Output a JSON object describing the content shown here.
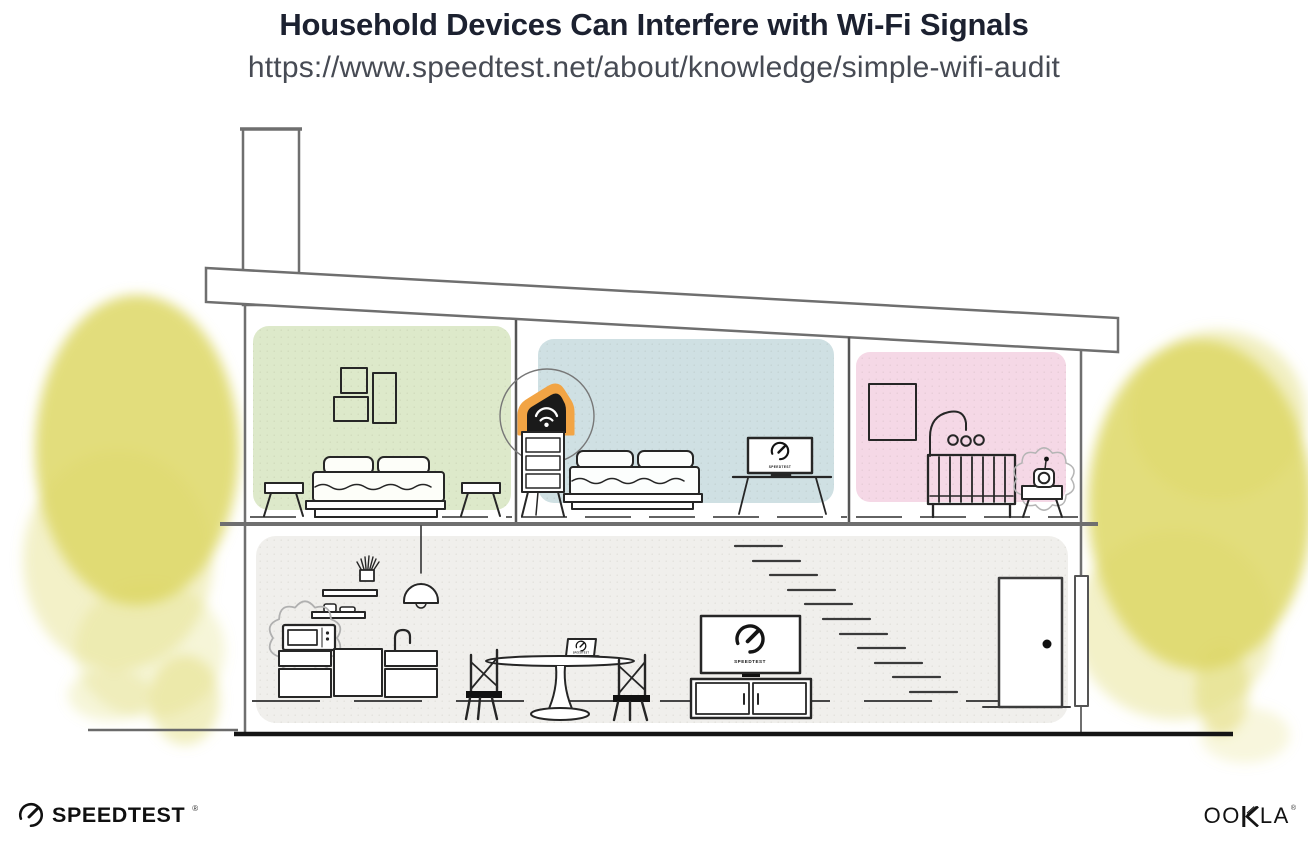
{
  "header": {
    "title": "Household Devices Can Interfere with Wi-Fi Signals",
    "url": "https://www.speedtest.net/about/knowledge/simple-wifi-audit"
  },
  "illustration": {
    "scene": "two-story house cross-section with a highlighted wi-fi router and household devices that interfere with wi-fi",
    "highlighted_device": "wifi-router",
    "interference_devices": [
      "microwave-oven",
      "baby-monitor"
    ],
    "screen_labels": {
      "bedroom_monitor": "SPEEDTEST",
      "living_room_tv": "SPEEDTEST",
      "dining_laptop": "SPEEDTEST"
    },
    "colors": {
      "bedroom_green": "#dde9ca",
      "bedroom_blue": "#cfe0e3",
      "nursery_pink": "#f5d8e6",
      "ground_floor_gray": "#f0efec",
      "router_highlight_orange": "#f2a444",
      "foliage_yellow": "#ddd765",
      "line_dark": "#262626",
      "structure_gray": "#6f6f6f"
    }
  },
  "footer": {
    "speedtest": {
      "wordmark": "SPEEDTEST",
      "registered_mark": "®"
    },
    "ookla": {
      "wordmark_left": "OO",
      "wordmark_right": "LA",
      "registered_mark": "®"
    }
  }
}
